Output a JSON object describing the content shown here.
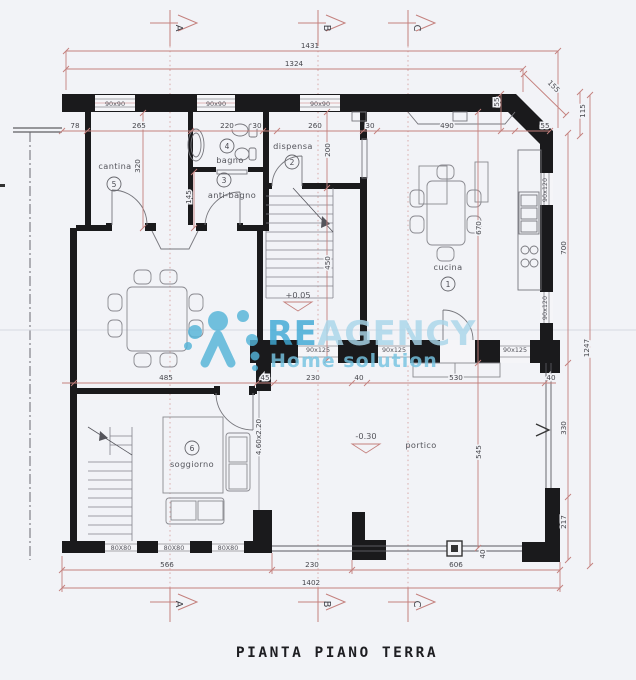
{
  "title": "PIANTA PIANO TERRA",
  "watermark": {
    "brand_bold": "RE",
    "brand_light": "AGENCY",
    "tagline": "Home solution"
  },
  "section_markers": {
    "a": "A",
    "b": "B",
    "c": "C"
  },
  "rooms": {
    "cucina": {
      "num": "1",
      "name": "cucina"
    },
    "dispensa": {
      "num": "2",
      "name": "dispensa"
    },
    "antibagno": {
      "num": "3",
      "name": "anti-bagno"
    },
    "bagno": {
      "num": "4",
      "name": "bagno"
    },
    "cantina": {
      "num": "5",
      "name": "cantina"
    },
    "soggiorno": {
      "num": "6",
      "name": "soggiorno"
    },
    "portico": {
      "name": "portico"
    }
  },
  "levels": {
    "ground": "+0.05",
    "portico": "-0.30"
  },
  "colors": {
    "wall": "#1a1a1c",
    "dimension": "#c4807d",
    "watermark": "#54b4d8"
  },
  "dims": {
    "d1431": "1431",
    "d1324": "1324",
    "d78": "78",
    "d265": "265",
    "d220": "220",
    "d30": "30",
    "d260": "260",
    "d490": "490",
    "d55": "55",
    "d155": "155",
    "d115": "115",
    "d320": "320",
    "d145": "145",
    "d200": "200",
    "d450": "450",
    "d670": "670",
    "d700": "700",
    "d1247": "1247",
    "d485": "485",
    "d45": "45",
    "d230": "230",
    "d40": "40",
    "d530": "530",
    "d460x220": "4.60x2.20",
    "d545": "545",
    "d330": "330",
    "d217": "217",
    "d566": "566",
    "d606": "606",
    "d1402": "1402",
    "w90x90": "90x90",
    "w90x120": "90x120",
    "w90x125": "90x125",
    "w80x80": "80X80"
  }
}
